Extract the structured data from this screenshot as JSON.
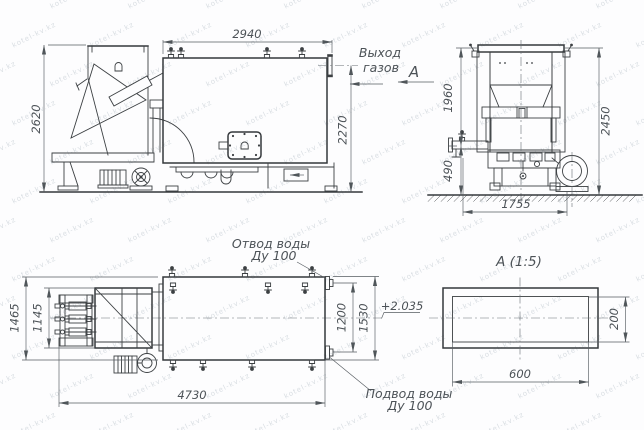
{
  "watermark": {
    "text": "kotel-kv.kz"
  },
  "colors": {
    "line": "#3c4043",
    "dimension": "#565c61",
    "text": "#4c5257",
    "background": "#fdfdfe",
    "watermark": "#aeb9c2"
  },
  "side_view": {
    "dim_body_length": "2940",
    "dim_overall_height": "2620",
    "dim_gas_outlet_height": "2270",
    "label_gas_out_line1": "Выход",
    "label_gas_out_line2": "газов",
    "section_marker": "А"
  },
  "front_view": {
    "dim_furnace_height": "1960",
    "dim_total_height": "2450",
    "dim_base_height": "490",
    "dim_base_width": "1755"
  },
  "plan_view": {
    "dim_overall_width": "1465",
    "dim_feeder_width": "1145",
    "dim_overall_length": "4730",
    "dim_nozzle_spacing": "1200",
    "dim_nozzle_overall": "1530",
    "elevation_mark": "+2.035",
    "label_water_out_line1": "Отвод воды",
    "label_water_out_line2": "Ду 100",
    "label_water_in_line1": "Подвод воды",
    "label_water_in_line2": "Ду 100"
  },
  "section_view": {
    "title": "А  (1:5)",
    "dim_width": "600",
    "dim_height": "200"
  }
}
